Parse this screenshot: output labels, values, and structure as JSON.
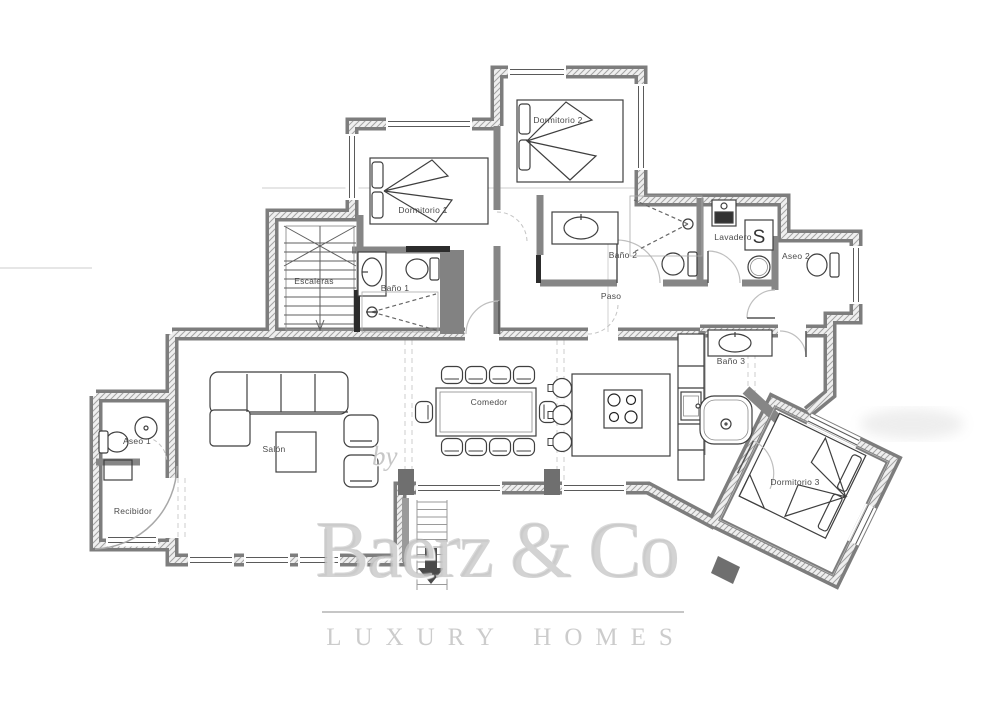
{
  "page": {
    "background": "#ffffff"
  },
  "colors": {
    "wall": "#7d7d7d",
    "wall_hatch": "#a3a3a3",
    "furniture_line": "#3f3f3f",
    "label_text": "#4a4a4a",
    "door_arc": "#bfbfbf",
    "watermark": "#c6c6c6"
  },
  "rooms": {
    "dormitorio1": {
      "label": "Dormitorio 1"
    },
    "dormitorio2": {
      "label": "Dormitorio 2"
    },
    "dormitorio3": {
      "label": "Dormitorio 3"
    },
    "bano1": {
      "label": "Baño 1"
    },
    "bano2": {
      "label": "Baño 2"
    },
    "bano3": {
      "label": "Baño 3"
    },
    "aseo1": {
      "label": "Aseo 1"
    },
    "aseo2": {
      "label": "Aseo 2"
    },
    "escaleras": {
      "label": "Escaleras"
    },
    "paso": {
      "label": "Paso"
    },
    "lavadero": {
      "label": "Lavadero"
    },
    "salon": {
      "label": "Salón"
    },
    "comedor": {
      "label": "Comedor"
    },
    "recibidor": {
      "label": "Recibidor"
    }
  },
  "fixtures": {
    "washer_glyph": "S"
  },
  "watermark": {
    "by": "by",
    "brand": "Baerz & Co",
    "tagline": "LUXURY HOMES"
  }
}
